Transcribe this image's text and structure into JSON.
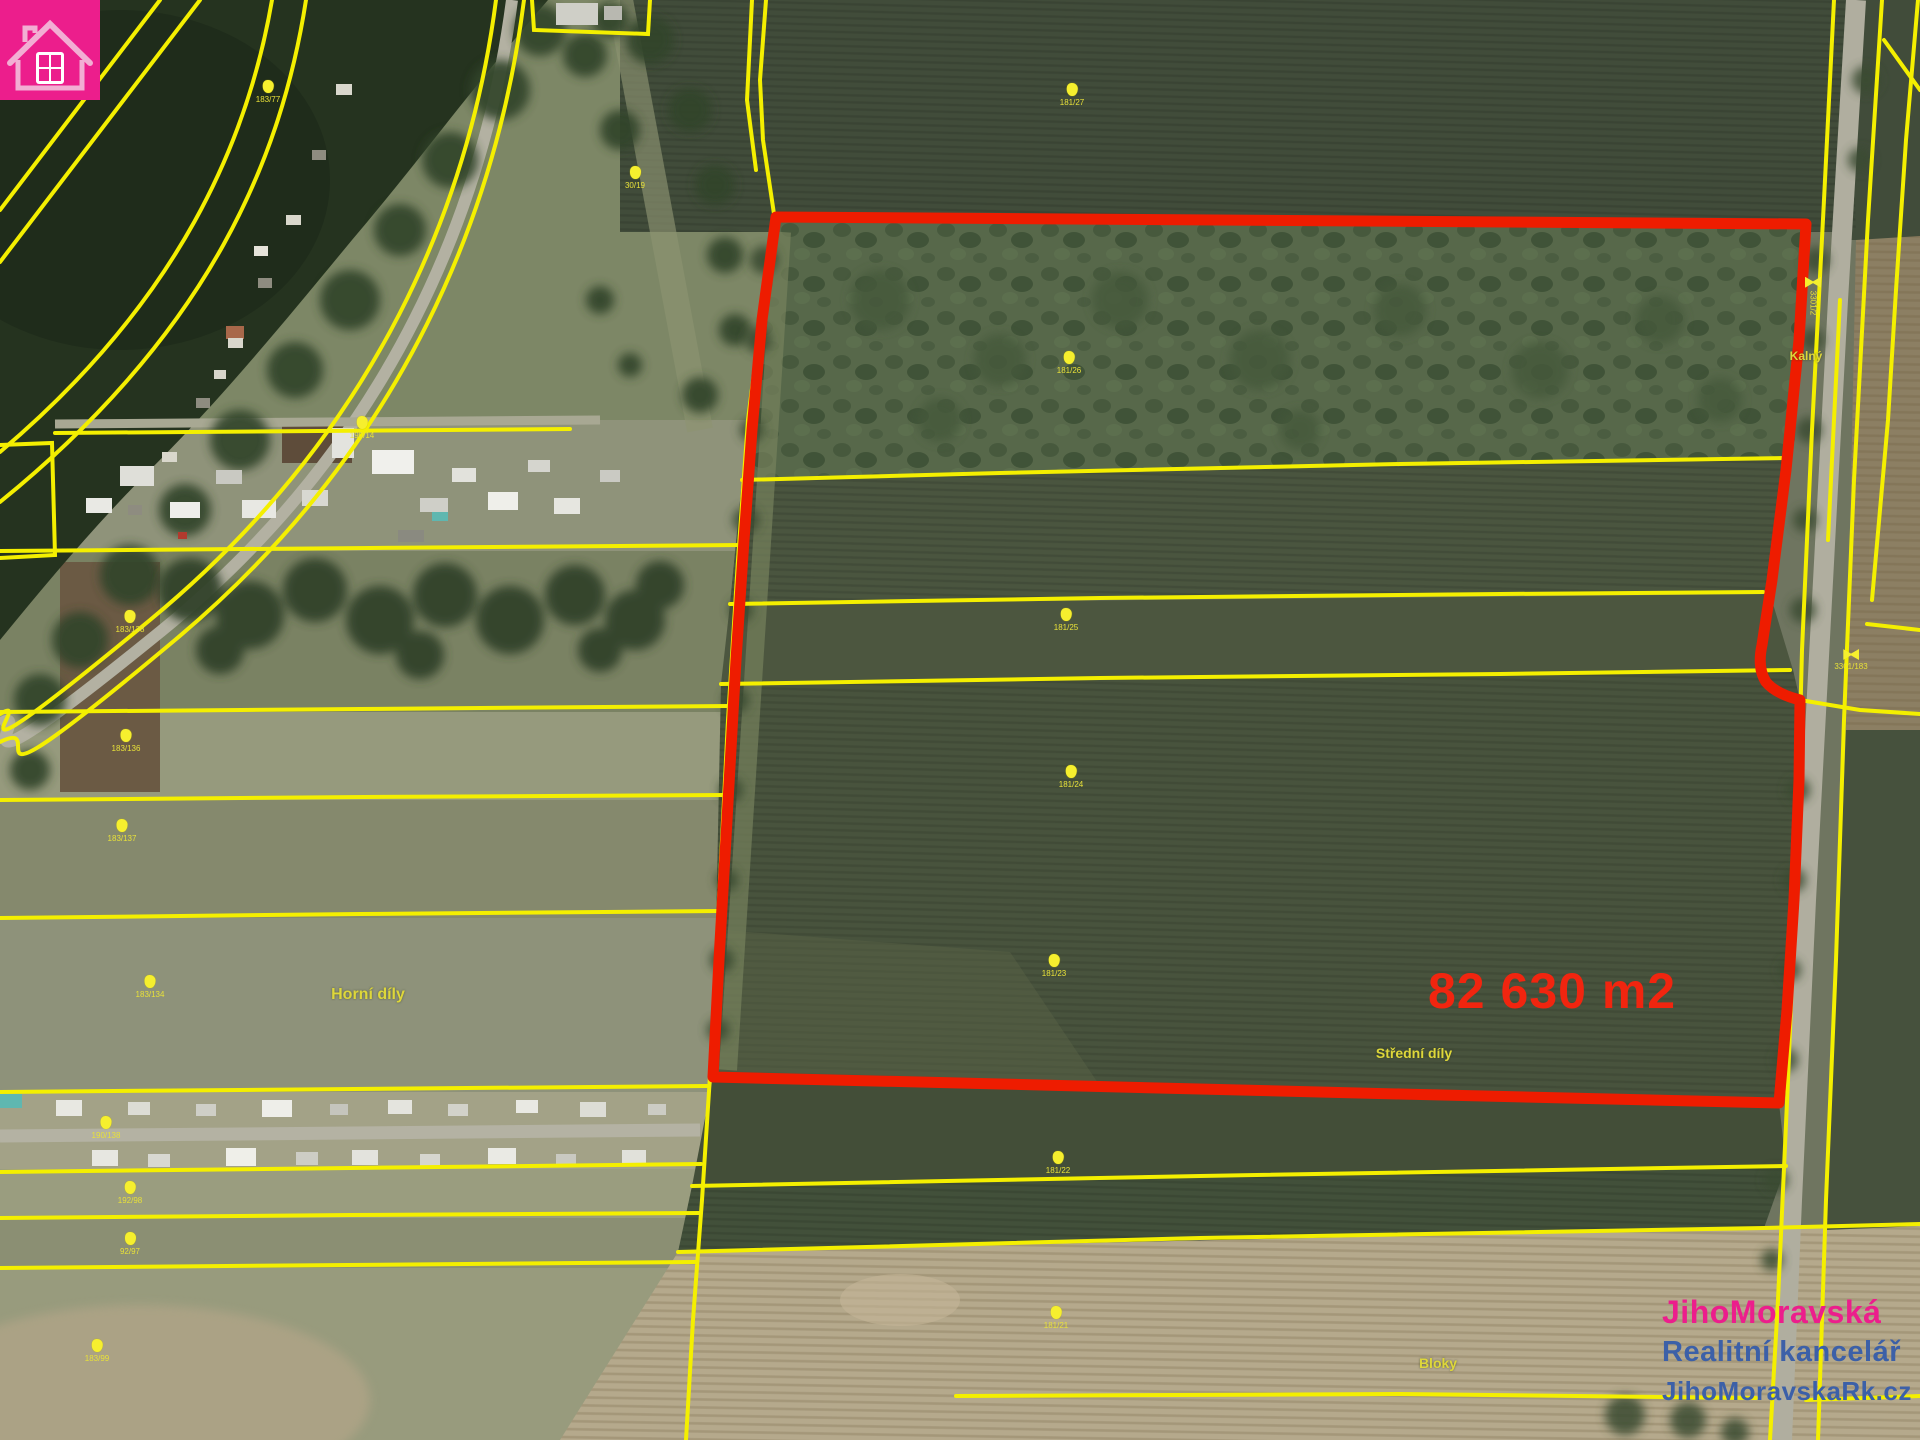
{
  "map": {
    "area_label": "82 630 m2",
    "area_label_color": "#f1250f",
    "outline_color": "#ee1c00",
    "cadastral_line_color": "#f4ef00",
    "label_color": "#ded73a",
    "place_labels": [
      {
        "text": "Horní díly",
        "x": 368,
        "y": 995,
        "size": 16
      },
      {
        "text": "Střední díly",
        "x": 1414,
        "y": 1053,
        "size": 14
      },
      {
        "text": "Bloky",
        "x": 1438,
        "y": 1363,
        "size": 14
      },
      {
        "text": "Kalný",
        "x": 1806,
        "y": 356,
        "size": 12
      }
    ],
    "markers": [
      {
        "x": 268,
        "y": 92,
        "label": "183/77",
        "type": "blob"
      },
      {
        "x": 635,
        "y": 178,
        "label": "30/19",
        "type": "blob"
      },
      {
        "x": 1072,
        "y": 95,
        "label": "181/27",
        "type": "blob"
      },
      {
        "x": 1069,
        "y": 363,
        "label": "181/26",
        "type": "blob"
      },
      {
        "x": 1066,
        "y": 620,
        "label": "181/25",
        "type": "blob"
      },
      {
        "x": 1071,
        "y": 777,
        "label": "181/24",
        "type": "blob"
      },
      {
        "x": 1054,
        "y": 966,
        "label": "181/23",
        "type": "blob"
      },
      {
        "x": 1058,
        "y": 1163,
        "label": "181/22",
        "type": "blob"
      },
      {
        "x": 1056,
        "y": 1318,
        "label": "181/21",
        "type": "blob"
      },
      {
        "x": 362,
        "y": 428,
        "label": "190/14",
        "type": "blob"
      },
      {
        "x": 130,
        "y": 622,
        "label": "183/138",
        "type": "blob"
      },
      {
        "x": 126,
        "y": 741,
        "label": "183/136",
        "type": "blob"
      },
      {
        "x": 122,
        "y": 831,
        "label": "183/137",
        "type": "blob"
      },
      {
        "x": 150,
        "y": 987,
        "label": "183/134",
        "type": "blob"
      },
      {
        "x": 106,
        "y": 1128,
        "label": "190/138",
        "type": "blob"
      },
      {
        "x": 130,
        "y": 1193,
        "label": "192/98",
        "type": "blob"
      },
      {
        "x": 130,
        "y": 1244,
        "label": "92/97",
        "type": "blob"
      },
      {
        "x": 97,
        "y": 1351,
        "label": "183/99",
        "type": "blob"
      },
      {
        "x": 1813,
        "y": 296,
        "label": "3301/2",
        "type": "bowtie",
        "vertical": true
      },
      {
        "x": 1851,
        "y": 660,
        "label": "3301/183",
        "type": "bowtie"
      }
    ]
  },
  "logo": {
    "line1": "JihoMoravská",
    "line2": "Realitní kancelář",
    "line3": "JihoMoravskaRk.cz",
    "brand_color": "#ec1e8c",
    "secondary_color": "#3c60a8",
    "icon": "house-icon"
  }
}
